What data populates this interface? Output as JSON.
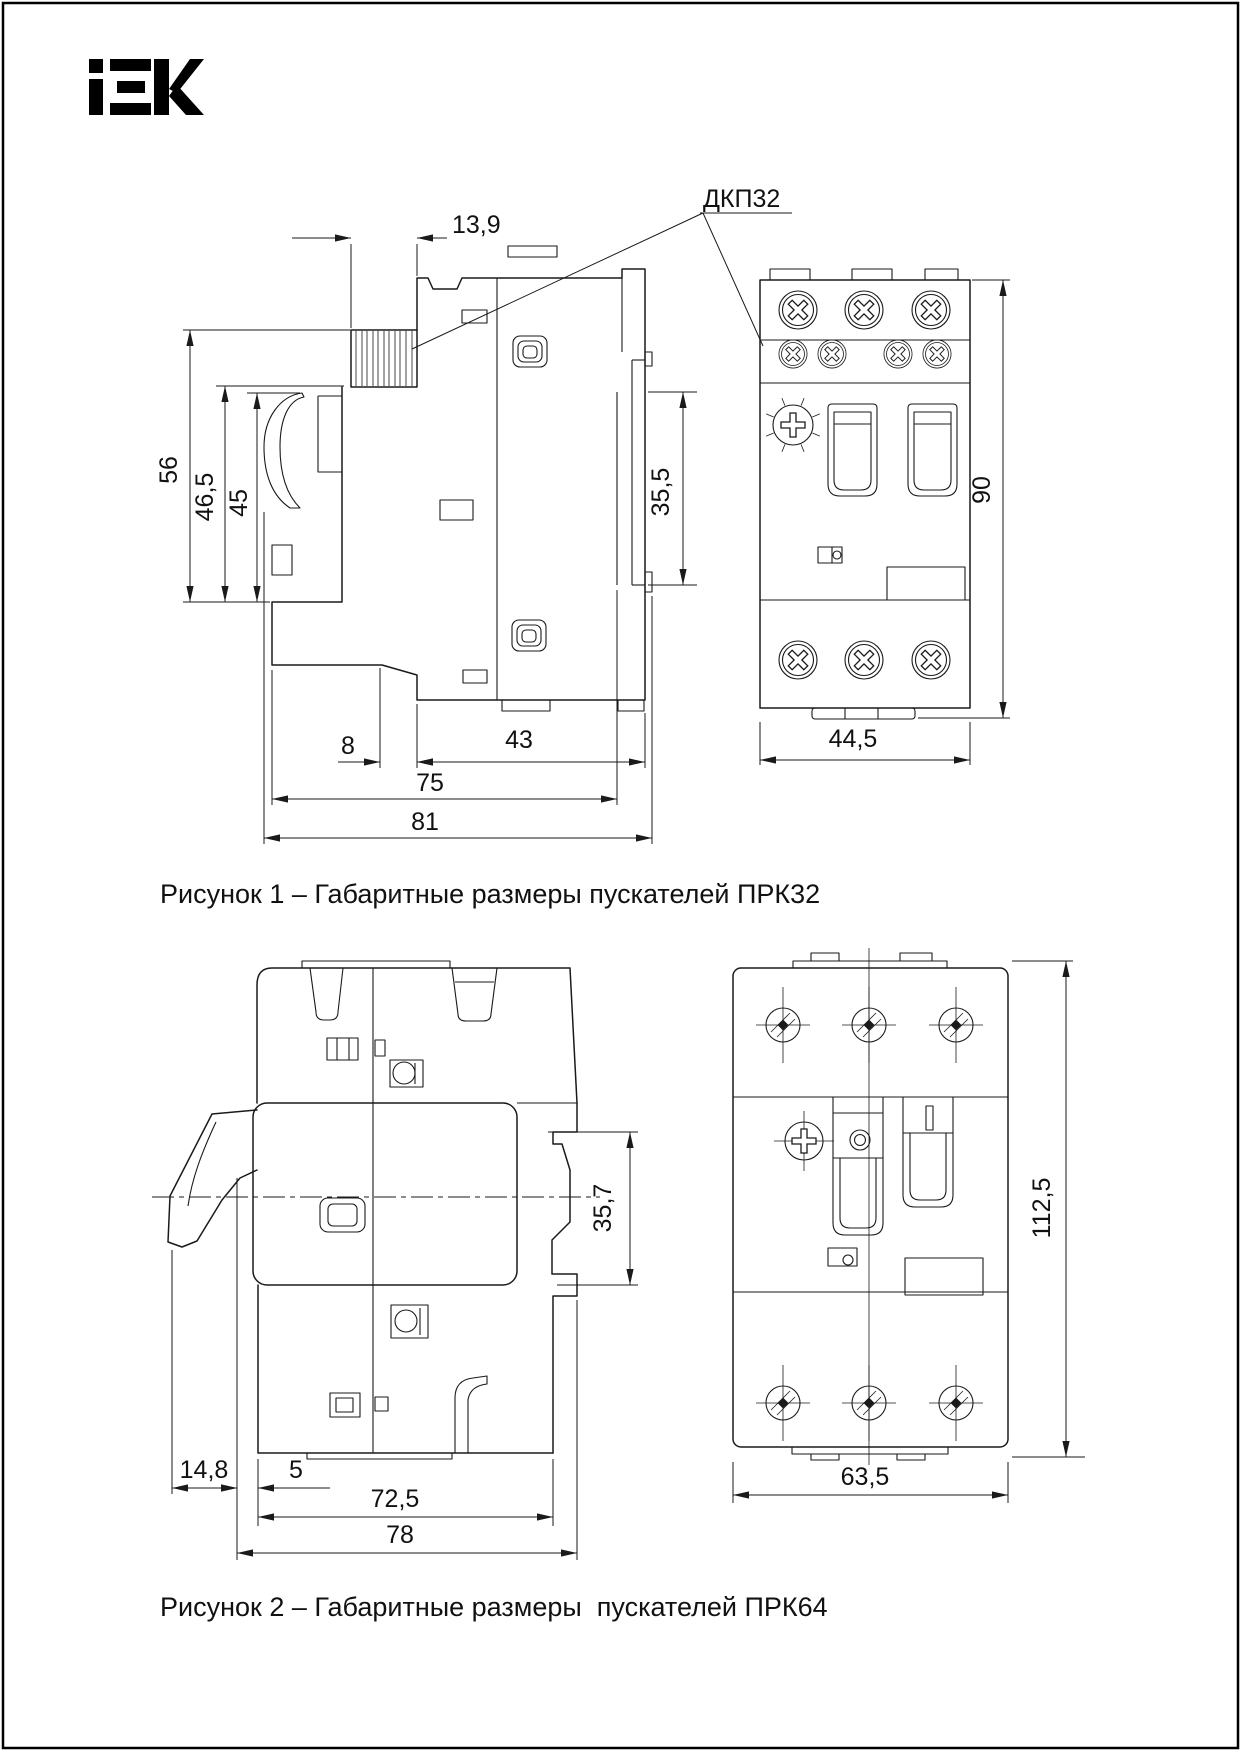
{
  "page": {
    "background": "#ffffff",
    "ink": "#1a1a1a",
    "border_color": "#000000"
  },
  "logo": {
    "text": "IEK"
  },
  "figure1": {
    "caption": "Рисунок 1 – Габаритные размеры пускателей ПРК32",
    "callout": "ДКП32",
    "dims": {
      "terminal_depth": "13,9",
      "height_total": "56",
      "height_upper": "46,5",
      "height_handle": "45",
      "din_span": "35,5",
      "foot_offset": "8",
      "base_depth": "43",
      "depth_body": "75",
      "depth_total": "81",
      "front_height": "90",
      "front_width": "44,5"
    }
  },
  "figure2": {
    "caption": "Рисунок 2 – Габаритные размеры  пускателей ПРК64",
    "dims": {
      "handle_offset": "14,8",
      "foot_offset": "5",
      "depth_body": "72,5",
      "depth_total": "78",
      "din_span": "35,7",
      "front_height": "112,5",
      "front_width": "63,5"
    }
  }
}
